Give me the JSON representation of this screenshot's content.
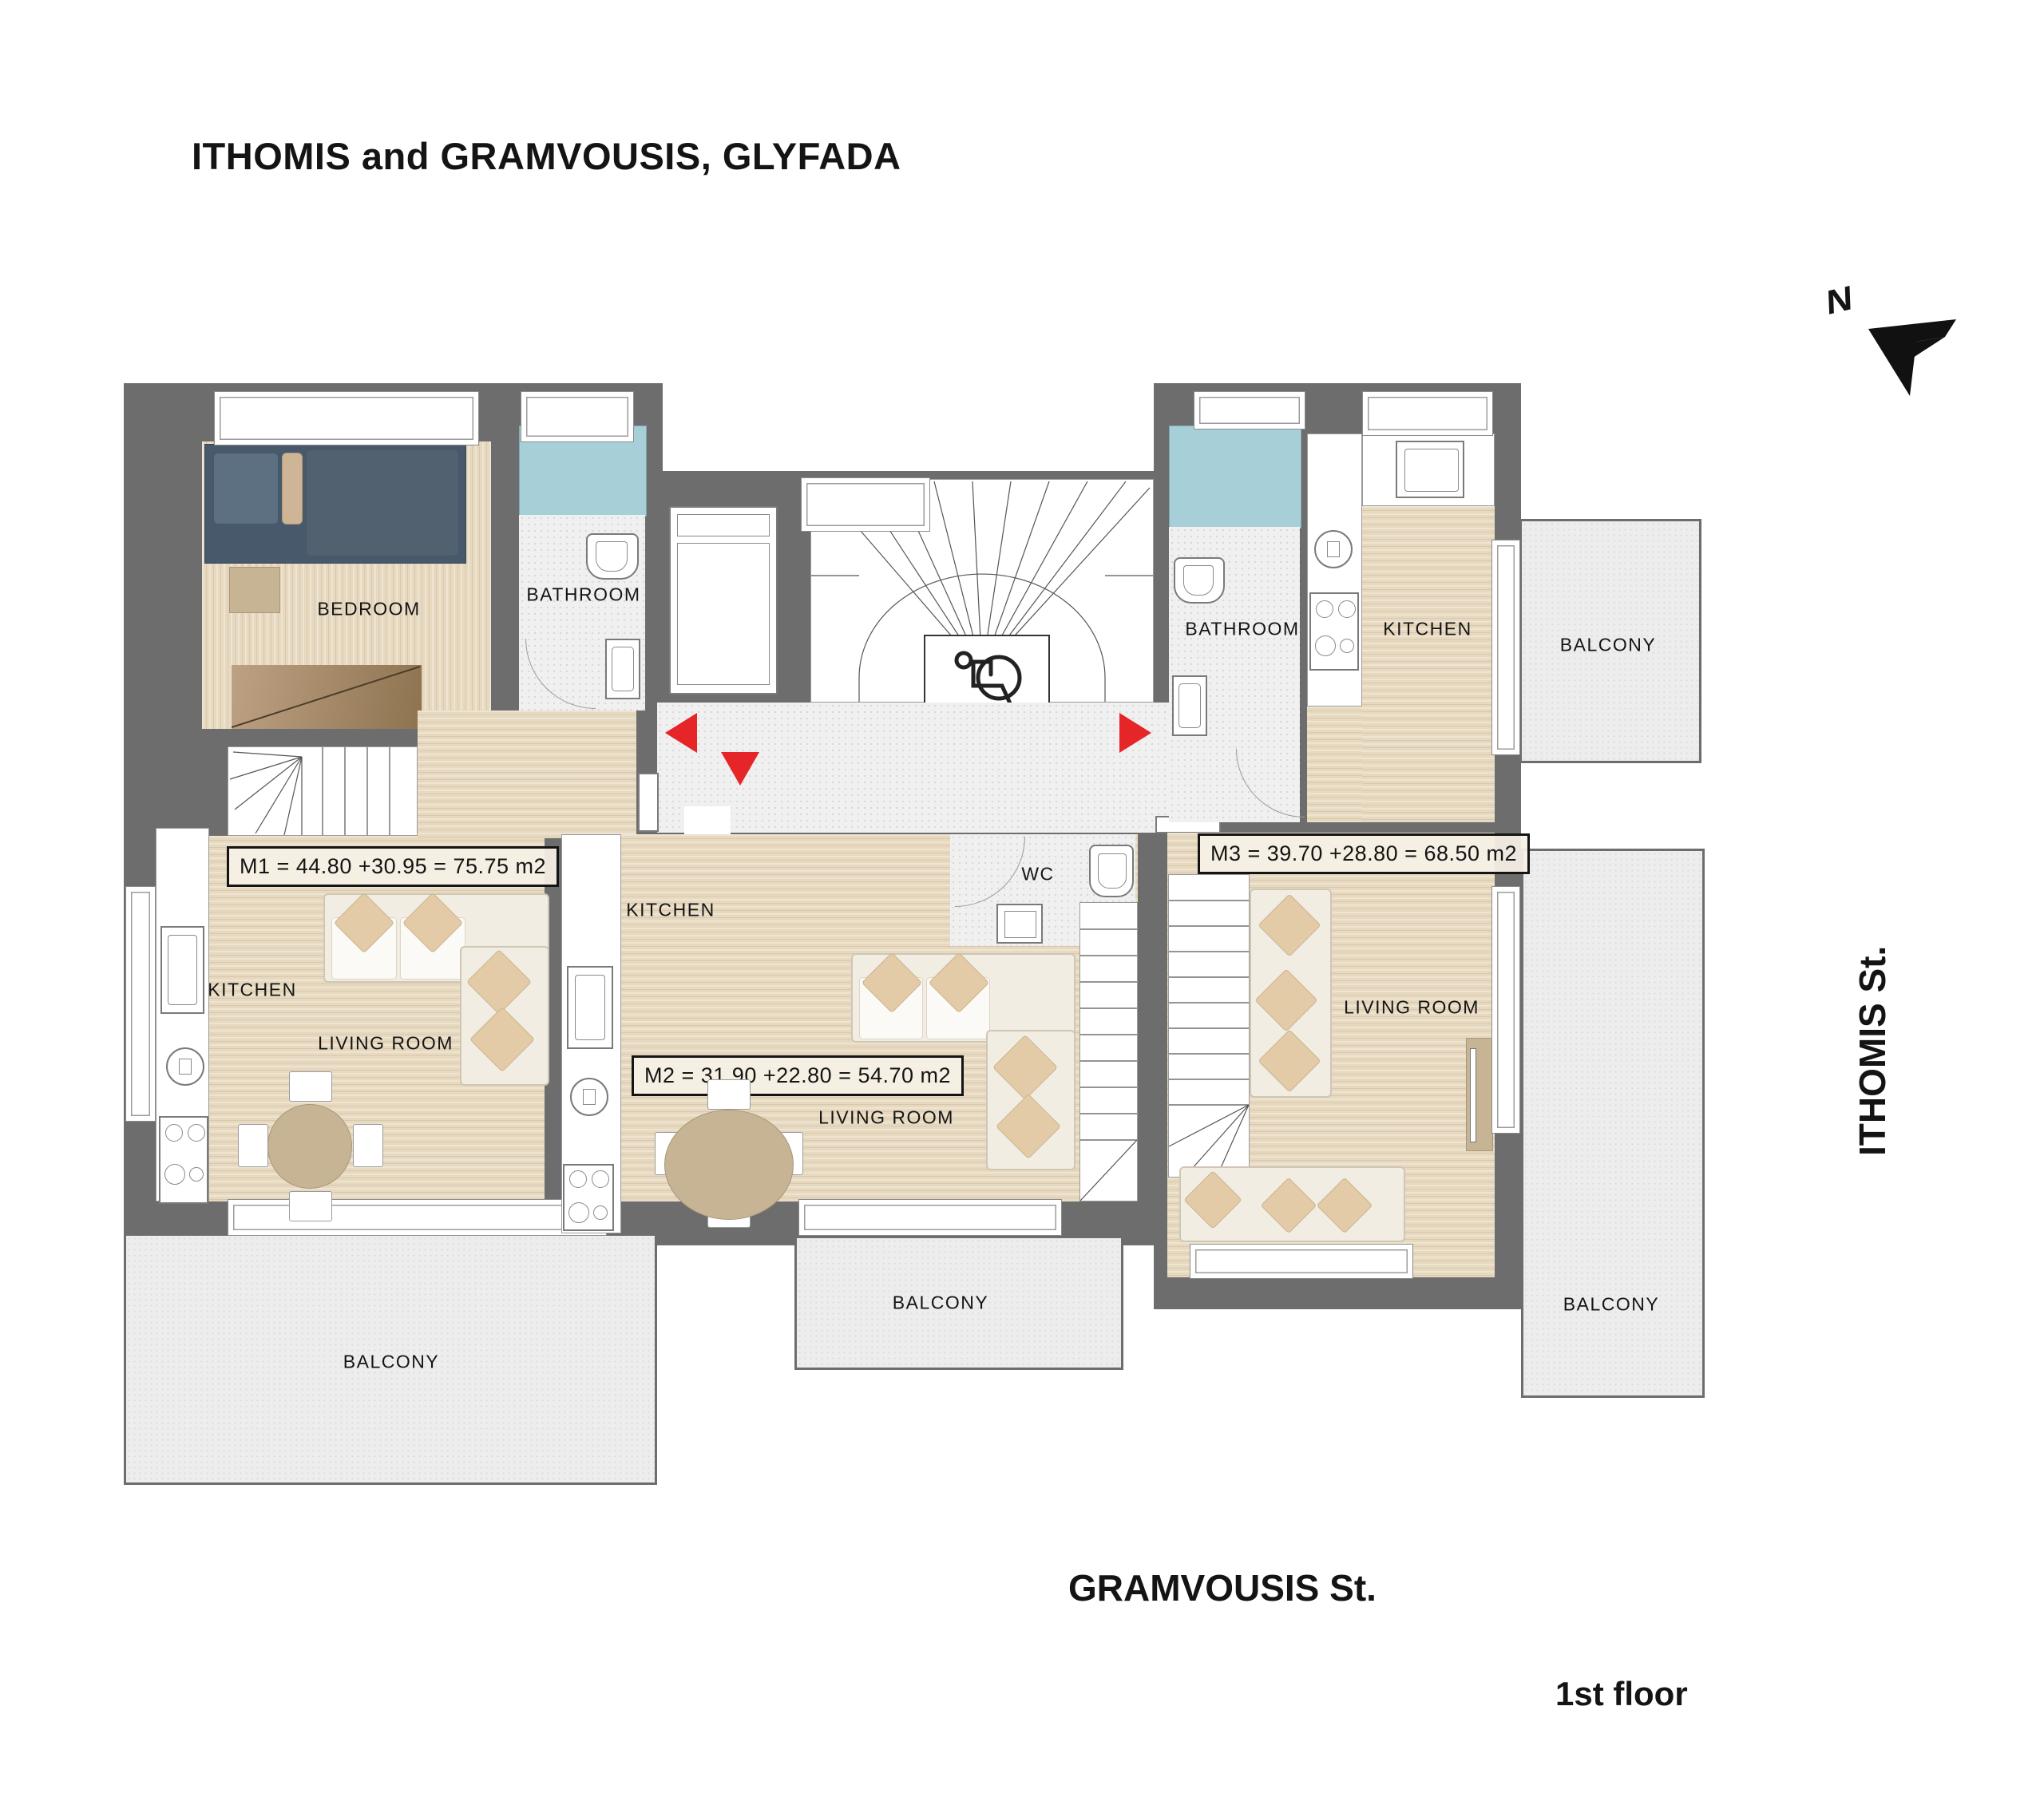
{
  "title": "ITHOMIS and GRAMVOUSIS, GLYFADA",
  "compass": {
    "north": "N"
  },
  "streets": {
    "right": "ITHOMIS St.",
    "bottom": "GRAMVOUSIS St."
  },
  "floor_label": "1st floor",
  "colors": {
    "wall": "#6d6d6d",
    "wood_floor": "#e7d9c0",
    "tile_floor": "#f0f0f0",
    "shower": "#a7cfd8",
    "balcony": "#ededed",
    "entrance_arrow": "#e52528",
    "label_text": "#141414"
  },
  "apartments": {
    "m1": {
      "area_label": "M1 = 44.80 +30.95 = 75.75 m2",
      "bedroom": "BEDROOM",
      "bathroom": "BATHROOM",
      "kitchen": "KITCHEN",
      "living_room": "LIVING ROOM",
      "balcony": "BALCONY"
    },
    "m2": {
      "area_label": "M2 = 31.90 +22.80 = 54.70 m2",
      "kitchen": "KITCHEN",
      "living_room": "LIVING ROOM",
      "wc": "WC",
      "balcony": "BALCONY"
    },
    "m3": {
      "area_label": "M3 = 39.70 +28.80 = 68.50 m2",
      "bathroom": "BATHROOM",
      "kitchen": "KITCHEN",
      "living_room": "LIVING ROOM",
      "balcony_top": "BALCONY",
      "balcony_bottom": "BALCONY"
    }
  }
}
